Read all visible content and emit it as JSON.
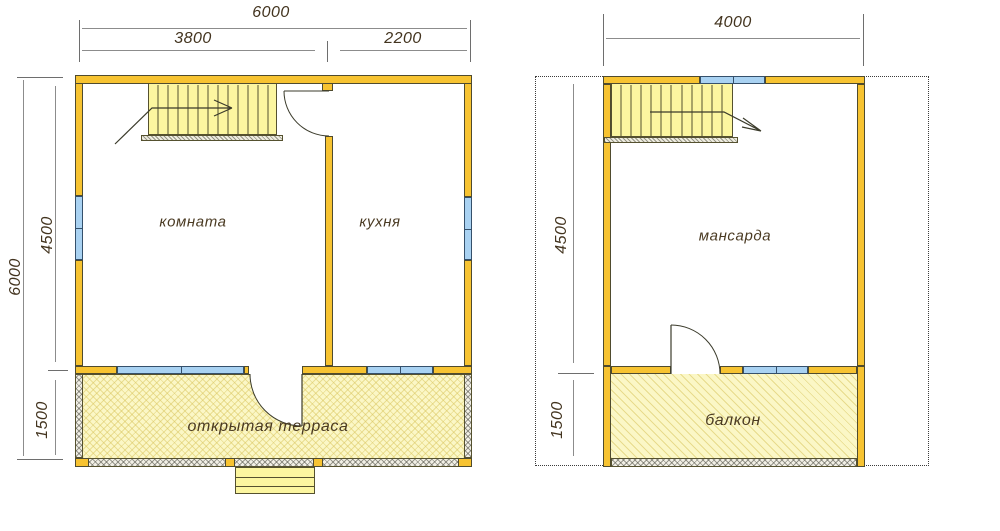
{
  "floor1": {
    "labels": {
      "room": "комната",
      "kitchen": "кухня",
      "terrace": "открытая  терраса"
    },
    "dims": {
      "width_total": "6000",
      "width_left": "3800",
      "width_right": "2200",
      "height_total": "6000",
      "height_main": "4500",
      "height_terrace": "1500"
    }
  },
  "floor2": {
    "labels": {
      "attic": "мансарда",
      "balcony": "балкон"
    },
    "dims": {
      "width_total": "4000",
      "height_main": "4500",
      "height_balcony": "1500"
    }
  },
  "colors": {
    "wall": "#F7C331",
    "window": "#A9D2F2",
    "stairs_fill": "#FCF6A0",
    "terrace_fill": "#FBF7C6",
    "outline": "#4F4B2E",
    "dimension_line": "#8C8C8C",
    "label_text": "#4A3A22"
  }
}
